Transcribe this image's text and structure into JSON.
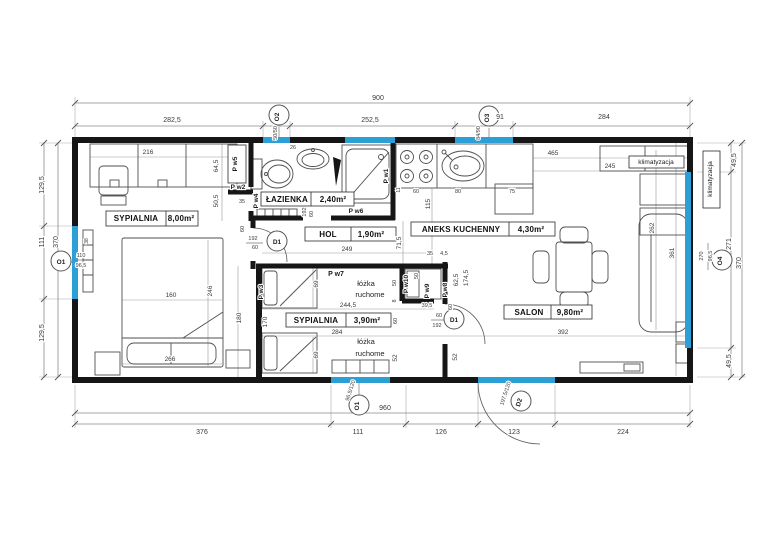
{
  "document": {
    "type": "floor-plan",
    "units": "cm"
  },
  "colors": {
    "wall": "#161616",
    "window": "#2b9fd6",
    "dimension": "#8a8a8a",
    "text": "#3a3a3a"
  },
  "rooms": [
    {
      "name": "SYPIALNIA",
      "area": "8,00m²"
    },
    {
      "name": "ŁAZIENKA",
      "area": "2,40m²"
    },
    {
      "name": "HOL",
      "area": "1,90m²"
    },
    {
      "name": "ANEKS KUCHENNY",
      "area": "4,30m²"
    },
    {
      "name": "SYPIALNIA",
      "area": "3,90m²"
    },
    {
      "name": "SALON",
      "area": "9,80m²"
    }
  ],
  "labels": [
    {
      "n": "dim-top-total",
      "t": "900",
      "x": 378,
      "y": 100,
      "s": 7
    },
    {
      "n": "dim-top-282-5",
      "t": "282,5",
      "x": 172,
      "y": 122,
      "s": 7
    },
    {
      "n": "dim-top-252-5",
      "t": "252,5",
      "x": 370,
      "y": 122,
      "s": 7
    },
    {
      "n": "dim-top-91",
      "t": "91",
      "x": 500,
      "y": 119,
      "s": 7
    },
    {
      "n": "dim-top-284",
      "t": "284",
      "x": 604,
      "y": 119,
      "s": 7
    },
    {
      "n": "marker-o2",
      "t": "O2",
      "x": 279,
      "y": 117,
      "r": -90,
      "s": 6.5,
      "c": "marker"
    },
    {
      "n": "dim-o2-size",
      "t": "50/50",
      "x": 277,
      "y": 133,
      "r": -90,
      "s": 5.5
    },
    {
      "n": "marker-o3",
      "t": "O3",
      "x": 489,
      "y": 118,
      "r": -90,
      "s": 6.5,
      "c": "marker"
    },
    {
      "n": "dim-o3-size",
      "t": "84/90",
      "x": 480,
      "y": 133,
      "r": -90,
      "s": 5.5
    },
    {
      "n": "dim-left-129-5-a",
      "t": "129,5",
      "x": 44,
      "y": 185,
      "r": -90,
      "s": 7
    },
    {
      "n": "dim-left-111",
      "t": "111",
      "x": 44,
      "y": 242,
      "r": -90,
      "s": 7
    },
    {
      "n": "dim-left-370",
      "t": "370",
      "x": 58,
      "y": 242,
      "r": -90,
      "s": 7
    },
    {
      "n": "dim-left-129-5-b",
      "t": "129,5",
      "x": 44,
      "y": 333,
      "r": -90,
      "s": 7
    },
    {
      "n": "marker-o1-left",
      "t": "O1",
      "x": 61,
      "y": 264,
      "s": 6.5,
      "c": "marker"
    },
    {
      "n": "dim-o1-left-w",
      "t": "110",
      "x": 81,
      "y": 257,
      "s": 5.5
    },
    {
      "n": "dim-o1-left-h",
      "t": "96,5",
      "x": 81,
      "y": 267,
      "s": 5.5
    },
    {
      "n": "anno-klimatyzacja-out",
      "t": "klimatyzacja",
      "x": 712,
      "y": 179,
      "r": -90,
      "s": 6.5,
      "c": "anno"
    },
    {
      "n": "dim-right-49-5-a",
      "t": "49,5",
      "x": 736,
      "y": 160,
      "r": -90,
      "s": 7
    },
    {
      "n": "dim-o4-w",
      "t": "270",
      "x": 703,
      "y": 256,
      "r": -90,
      "s": 5.5
    },
    {
      "n": "dim-o4-h",
      "t": "96,5",
      "x": 712,
      "y": 256,
      "r": -90,
      "s": 5.5
    },
    {
      "n": "marker-o4",
      "t": "O4",
      "x": 722,
      "y": 261,
      "r": -90,
      "s": 6.5,
      "c": "marker"
    },
    {
      "n": "dim-right-271",
      "t": "271",
      "x": 731,
      "y": 244,
      "r": -90,
      "s": 7
    },
    {
      "n": "dim-right-370",
      "t": "370",
      "x": 741,
      "y": 263,
      "r": -90,
      "s": 7
    },
    {
      "n": "dim-right-49-5-b",
      "t": "49,5",
      "x": 731,
      "y": 361,
      "r": -90,
      "s": 7
    },
    {
      "n": "dim-bot-376",
      "t": "376",
      "x": 202,
      "y": 434,
      "s": 7
    },
    {
      "n": "dim-bot-111",
      "t": "111",
      "x": 358,
      "y": 434,
      "s": 7
    },
    {
      "n": "dim-bot-126",
      "t": "126",
      "x": 441,
      "y": 434,
      "s": 7
    },
    {
      "n": "dim-bot-123",
      "t": "123",
      "x": 514,
      "y": 434,
      "s": 7
    },
    {
      "n": "dim-bot-224",
      "t": "224",
      "x": 623,
      "y": 434,
      "s": 7
    },
    {
      "n": "dim-bot-960",
      "t": "960",
      "x": 385,
      "y": 410,
      "s": 7
    },
    {
      "n": "marker-o1-bottom",
      "t": "O1",
      "x": 359,
      "y": 406,
      "r": -90,
      "s": 6.5,
      "c": "marker"
    },
    {
      "n": "dim-o1-bottom-size",
      "t": "96,5/120",
      "x": 352,
      "y": 391,
      "r": -72,
      "s": 5.5
    },
    {
      "n": "marker-d2",
      "t": "D2",
      "x": 521,
      "y": 403,
      "r": -72,
      "s": 6.5,
      "c": "marker"
    },
    {
      "n": "dim-d2-size",
      "t": "197,5/120",
      "x": 507,
      "y": 394,
      "r": -72,
      "s": 5.5
    },
    {
      "n": "room-sypialnia1-name",
      "t": "SYPIALNIA",
      "x": 136,
      "y": 221,
      "s": 8,
      "c": "room"
    },
    {
      "n": "room-sypialnia1-area",
      "t": "8,00m²",
      "x": 181,
      "y": 221,
      "s": 8,
      "c": "room"
    },
    {
      "n": "dim-216",
      "t": "216",
      "x": 148,
      "y": 154,
      "s": 6.5
    },
    {
      "n": "dim-64-5",
      "t": "64,5",
      "x": 218,
      "y": 166,
      "r": -90,
      "s": 6.5
    },
    {
      "n": "dim-50-5",
      "t": "50,5",
      "x": 218,
      "y": 201,
      "r": -90,
      "s": 6.5
    },
    {
      "n": "dim-38",
      "t": "38",
      "x": 88,
      "y": 241,
      "r": -90,
      "s": 5
    },
    {
      "n": "dim-160",
      "t": "160",
      "x": 171,
      "y": 297,
      "s": 6.5
    },
    {
      "n": "dim-246",
      "t": "246",
      "x": 212,
      "y": 291,
      "r": -90,
      "s": 6.5
    },
    {
      "n": "dim-266",
      "t": "266",
      "x": 170,
      "y": 361,
      "s": 6.5
    },
    {
      "n": "dim-180",
      "t": "180",
      "x": 241,
      "y": 318,
      "r": -90,
      "s": 6.5
    },
    {
      "n": "part-pw5",
      "t": "P w5",
      "x": 237,
      "y": 164,
      "r": -90,
      "s": 6.5,
      "c": "part"
    },
    {
      "n": "dim-26",
      "t": "26",
      "x": 293,
      "y": 149,
      "s": 5.5
    },
    {
      "n": "part-pw2",
      "t": "P w2",
      "x": 238,
      "y": 189,
      "s": 6.5,
      "c": "part"
    },
    {
      "n": "dim-35",
      "t": "35",
      "x": 242,
      "y": 203,
      "s": 5.5
    },
    {
      "n": "part-pw4",
      "t": "P w4",
      "x": 258,
      "y": 201,
      "r": -90,
      "s": 6.5,
      "c": "part"
    },
    {
      "n": "room-lazienka-name",
      "t": "ŁAZIENKA",
      "x": 287,
      "y": 202,
      "s": 8,
      "c": "room"
    },
    {
      "n": "room-lazienka-area",
      "t": "2,40m²",
      "x": 333,
      "y": 202,
      "s": 8,
      "c": "room"
    },
    {
      "n": "part-pw1",
      "t": "P w1",
      "x": 388,
      "y": 176,
      "r": -90,
      "s": 6.5,
      "c": "part"
    },
    {
      "n": "part-pw6",
      "t": "P w6",
      "x": 356,
      "y": 213,
      "s": 6.5,
      "c": "part"
    },
    {
      "n": "dim-bathdoor-192",
      "t": "192",
      "x": 306,
      "y": 212,
      "r": -90,
      "s": 5.5
    },
    {
      "n": "dim-bathdoor-60",
      "t": "60",
      "x": 313,
      "y": 214,
      "r": -90,
      "s": 5.5
    },
    {
      "n": "room-hol-name",
      "t": "HOL",
      "x": 328,
      "y": 237,
      "s": 8,
      "c": "room"
    },
    {
      "n": "room-hol-area",
      "t": "1,90m²",
      "x": 371,
      "y": 237,
      "s": 8,
      "c": "room"
    },
    {
      "n": "dim-249",
      "t": "249",
      "x": 347,
      "y": 251,
      "s": 6.5
    },
    {
      "n": "dim-71-5",
      "t": "71,5",
      "x": 401,
      "y": 243,
      "r": -90,
      "s": 6.5
    },
    {
      "n": "marker-d1-hol",
      "t": "D1",
      "x": 277,
      "y": 244,
      "s": 6.5,
      "c": "marker"
    },
    {
      "n": "dim-d1hol-192",
      "t": "192",
      "x": 253,
      "y": 240,
      "s": 5.5
    },
    {
      "n": "dim-d1hol-60",
      "t": "60",
      "x": 255,
      "y": 249,
      "s": 5.5
    },
    {
      "n": "dim-hol-60",
      "t": "60",
      "x": 244,
      "y": 229,
      "r": -90,
      "s": 5.5
    },
    {
      "n": "part-pw3",
      "t": "P w3",
      "x": 263,
      "y": 292,
      "r": -90,
      "s": 6.5,
      "c": "part"
    },
    {
      "n": "part-pw7",
      "t": "P w7",
      "x": 336,
      "y": 276,
      "s": 7,
      "c": "part"
    },
    {
      "n": "anno-lozka1-a",
      "t": "łóżka",
      "x": 366,
      "y": 286,
      "s": 7.5,
      "c": "anno"
    },
    {
      "n": "anno-lozka1-b",
      "t": "ruchome",
      "x": 370,
      "y": 297,
      "s": 7.5,
      "c": "anno"
    },
    {
      "n": "dim-69-a",
      "t": "69",
      "x": 318,
      "y": 284,
      "r": -90,
      "s": 6.5
    },
    {
      "n": "dim-244-5",
      "t": "244,5",
      "x": 348,
      "y": 307,
      "s": 6.5
    },
    {
      "n": "dim-50-a",
      "t": "50",
      "x": 396,
      "y": 283,
      "r": -90,
      "s": 5.5
    },
    {
      "n": "dim-8",
      "t": "8",
      "x": 396,
      "y": 301,
      "r": -90,
      "s": 5.5
    },
    {
      "n": "room-sypialnia2-name",
      "t": "SYPIALNIA",
      "x": 316,
      "y": 323,
      "s": 8,
      "c": "room"
    },
    {
      "n": "room-sypialnia2-area",
      "t": "3,90m²",
      "x": 367,
      "y": 323,
      "s": 8,
      "c": "room"
    },
    {
      "n": "dim-170",
      "t": "170",
      "x": 267,
      "y": 322,
      "r": -90,
      "s": 6.5
    },
    {
      "n": "dim-284-room",
      "t": "284",
      "x": 337,
      "y": 334,
      "s": 6.5
    },
    {
      "n": "anno-lozka2-a",
      "t": "łóżka",
      "x": 366,
      "y": 344,
      "s": 7.5,
      "c": "anno"
    },
    {
      "n": "anno-lozka2-b",
      "t": "ruchome",
      "x": 370,
      "y": 356,
      "s": 7.5,
      "c": "anno"
    },
    {
      "n": "dim-69-b",
      "t": "69",
      "x": 318,
      "y": 355,
      "r": -90,
      "s": 6.5
    },
    {
      "n": "dim-60-a",
      "t": "60",
      "x": 397,
      "y": 321,
      "r": -90,
      "s": 5.5
    },
    {
      "n": "dim-52-a",
      "t": "52",
      "x": 397,
      "y": 358,
      "r": -90,
      "s": 6.5
    },
    {
      "n": "part-pw10",
      "t": "P w10",
      "x": 408,
      "y": 284,
      "r": -90,
      "s": 6.5,
      "c": "part"
    },
    {
      "n": "dim-50-b",
      "t": "50",
      "x": 418,
      "y": 276,
      "r": -90,
      "s": 5.5
    },
    {
      "n": "part-pw9",
      "t": "P w9",
      "x": 429,
      "y": 291,
      "r": -90,
      "s": 6.5,
      "c": "part"
    },
    {
      "n": "part-pw8",
      "t": "P w8",
      "x": 447,
      "y": 290,
      "r": -90,
      "s": 6.5,
      "c": "part"
    },
    {
      "n": "dim-62-5",
      "t": "62,5",
      "x": 458,
      "y": 280,
      "r": -90,
      "s": 6.5
    },
    {
      "n": "dim-174-5",
      "t": "174,5",
      "x": 468,
      "y": 278,
      "r": -90,
      "s": 6.5
    },
    {
      "n": "dim-39-5",
      "t": "39,5",
      "x": 427,
      "y": 307,
      "s": 5.5
    },
    {
      "n": "dim-35-b",
      "t": "35",
      "x": 430,
      "y": 255,
      "s": 5.5
    },
    {
      "n": "dim-4-5",
      "t": "4,5",
      "x": 444,
      "y": 255,
      "s": 5.5
    },
    {
      "n": "marker-d1-salon",
      "t": "D1",
      "x": 454,
      "y": 322,
      "s": 6.5,
      "c": "marker"
    },
    {
      "n": "dim-d1salon-60",
      "t": "60",
      "x": 439,
      "y": 317,
      "s": 5.5
    },
    {
      "n": "dim-d1salon-192",
      "t": "192",
      "x": 437,
      "y": 327,
      "s": 5.5
    },
    {
      "n": "dim-closet-60",
      "t": "60",
      "x": 452,
      "y": 307,
      "r": -90,
      "s": 5.5
    },
    {
      "n": "dim-11",
      "t": "11",
      "x": 400,
      "y": 190,
      "r": -90,
      "s": 5
    },
    {
      "n": "dim-60-k",
      "t": "60",
      "x": 416,
      "y": 193,
      "s": 5.5
    },
    {
      "n": "dim-80",
      "t": "80",
      "x": 458,
      "y": 193,
      "s": 5.5
    },
    {
      "n": "dim-75",
      "t": "75",
      "x": 512,
      "y": 193,
      "s": 5.5
    },
    {
      "n": "dim-115",
      "t": "115",
      "x": 430,
      "y": 204,
      "r": -90,
      "s": 6.5
    },
    {
      "n": "room-aneks-name",
      "t": "ANEKS KUCHENNY",
      "x": 461,
      "y": 232,
      "s": 8,
      "c": "room"
    },
    {
      "n": "room-aneks-area",
      "t": "4,30m²",
      "x": 531,
      "y": 232,
      "s": 8,
      "c": "room"
    },
    {
      "n": "dim-465",
      "t": "465",
      "x": 553,
      "y": 155,
      "s": 6.5
    },
    {
      "n": "dim-245",
      "t": "245",
      "x": 610,
      "y": 168,
      "s": 6.5
    },
    {
      "n": "anno-klimatyzacja-in",
      "t": "klimatyzacja",
      "x": 656,
      "y": 164,
      "s": 6.5,
      "c": "anno"
    },
    {
      "n": "dim-262",
      "t": "262",
      "x": 654,
      "y": 228,
      "r": -90,
      "s": 6.5
    },
    {
      "n": "dim-361",
      "t": "361",
      "x": 674,
      "y": 253,
      "r": -90,
      "s": 6.5
    },
    {
      "n": "room-salon-name",
      "t": "SALON",
      "x": 529,
      "y": 315,
      "s": 8,
      "c": "room"
    },
    {
      "n": "room-salon-area",
      "t": "9,80m²",
      "x": 570,
      "y": 315,
      "s": 8,
      "c": "room"
    },
    {
      "n": "dim-392",
      "t": "392",
      "x": 563,
      "y": 334,
      "s": 6.5
    },
    {
      "n": "dim-52-b",
      "t": "52",
      "x": 457,
      "y": 357,
      "r": -90,
      "s": 6.5
    }
  ]
}
